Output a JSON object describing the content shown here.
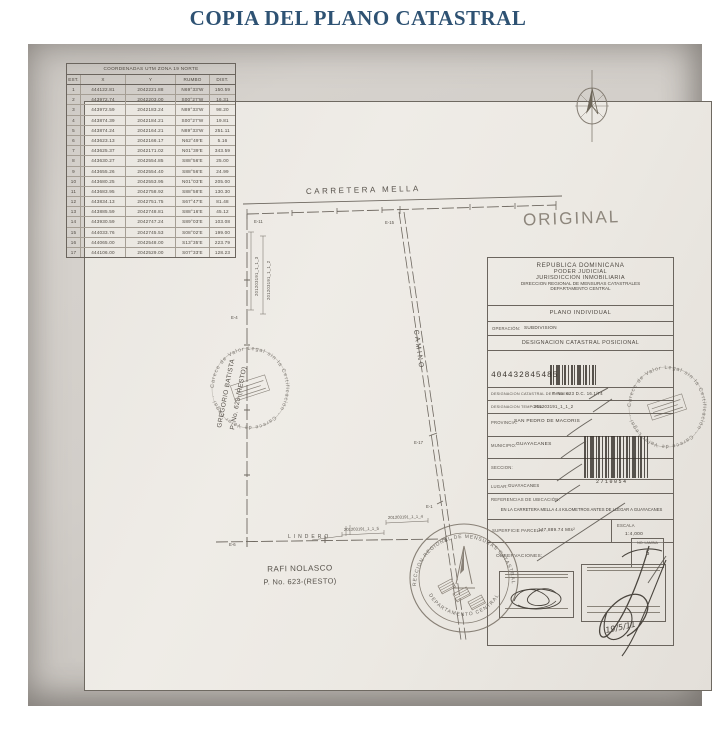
{
  "page": {
    "title": "COPIA DEL PLANO CATASTRAL"
  },
  "coords_table": {
    "title": "COORDENADAS UTM ZONA 19 NORTE",
    "headers": [
      "EST.",
      "X",
      "Y",
      "RUMBO",
      "DIST."
    ],
    "rows": [
      [
        "1",
        "444122.81",
        "2042221.88",
        "N69°33'W",
        "150.59"
      ],
      [
        "2",
        "443972.74",
        "2042203.00",
        "S00°27'W",
        "16.31"
      ],
      [
        "3",
        "443972.59",
        "2042183.24",
        "N89°33'W",
        "98.20"
      ],
      [
        "4",
        "443874.39",
        "2042184.21",
        "S00°27'W",
        "19.81"
      ],
      [
        "5",
        "443874.24",
        "2042164.21",
        "N89°33'W",
        "251.11"
      ],
      [
        "6",
        "443623.13",
        "2042166.17",
        "N62°49'E",
        "5.16"
      ],
      [
        "7",
        "443625.37",
        "2042171.02",
        "N01°39'E",
        "343.59"
      ],
      [
        "8",
        "443630.27",
        "2042554.85",
        "S88°56'E",
        "25.00"
      ],
      [
        "9",
        "443655.26",
        "2042554.40",
        "S88°56'E",
        "24.99"
      ],
      [
        "10",
        "443680.25",
        "2042553.95",
        "N01°03'E",
        "205.00"
      ],
      [
        "11",
        "443683.95",
        "2042758.92",
        "S88°58'E",
        "130.30"
      ],
      [
        "12",
        "443834.13",
        "2042751.75",
        "S67°47'E",
        "81.48"
      ],
      [
        "13",
        "443885.59",
        "2042748.81",
        "S88°16'E",
        "45.12"
      ],
      [
        "14",
        "443930.59",
        "2042747.24",
        "S89°03'E",
        "103.08"
      ],
      [
        "15",
        "444033.76",
        "2042745.53",
        "S08°02'E",
        "199.00"
      ],
      [
        "16",
        "444065.00",
        "2042548.00",
        "S13°35'E",
        "223.79"
      ],
      [
        "17",
        "444106.00",
        "2042529.00",
        "S07°33'E",
        "128.23"
      ]
    ]
  },
  "map": {
    "road_label": "CARRETERA MELLA",
    "camino_label": "CAMINO",
    "lindero_label": "LINDERO",
    "original_mark": "ORIGINAL",
    "owner_bottom_name": "RAFI NOLASCO",
    "owner_bottom_parcel": "P. No. 623-(RESTO)",
    "owner_left_name": "GREGORIO BATISTA",
    "owner_left_parcel": "P. No. 623-(RESTO)",
    "strip_label_1": "201203191_1_1_3",
    "strip_label_2": "201203191_1_1_2",
    "bottom_label_1": "201203191_1_1_4",
    "bottom_label_2": "201203191_1_1_5",
    "stations": {
      "e11": "E-11",
      "e15": "E-15",
      "e17": "E-17",
      "e6": "E-6",
      "e4": "E-4",
      "e1": "E-1"
    }
  },
  "info_panel": {
    "header_lines": [
      "REPUBLICA DOMINICANA",
      "PODER JUDICIAL",
      "JURISDICCION INMOBILIARIA",
      "DIRECCION REGIONAL DE MENSURAS CATASTRALES",
      "DEPARTAMENTO CENTRAL"
    ],
    "plan_type": "PLANO INDIVIDUAL",
    "operacion_label": "OPERACIÓN:",
    "operacion_value": "SUBDIVISION",
    "designacion_title": "DESIGNACION CATASTRAL POSICIONAL",
    "barcode_number": "404432845485",
    "origen_label": "DESIGNACION CATASTRAL DE ORIGEN:",
    "origen_value": "P. No. 623 D.C. 16.1/74",
    "temporal_label": "DESIGNACION TEMPORAL:",
    "temporal_value": "201203191_1_1_2",
    "provincia_label": "PROVINCIA:",
    "provincia_value": "SAN PEDRO DE MACORIS",
    "municipio_label": "MUNICIPIO:",
    "municipio_value": "GUAYACANES",
    "seccion_label": "SECCION:",
    "lugar_label": "LUGAR:",
    "lugar_value": "GUAYACANES",
    "barcode2_number": "2710054",
    "referencias_label": "REFERENCIAS DE UBICACIÓN:",
    "referencias_value": "EN LA CARRETERA MELLA 4.4 KILOMETROS ANTES DE LLEGAR A GUAYACANES",
    "superficie_label": "SUPERFICIE PARCELA:",
    "superficie_value": "147,889.74 Mts²",
    "escala_label": "ESCALA",
    "escala_value": "1:4,000",
    "lamina_label": "NO. LAMINA",
    "lamina_value": "5",
    "observaciones_label": "OBSERVACIONES:",
    "date_hand": "19/5/11"
  },
  "stamps": {
    "watermark_text": "Carece de Valor Legal sin la Certificación · Carece de Valor Legal ·",
    "seal_top": "DIRECCION REGIONAL DE MENSURAS CATASTRALES",
    "seal_bottom": "DEPARTAMENTO CENTRAL"
  }
}
